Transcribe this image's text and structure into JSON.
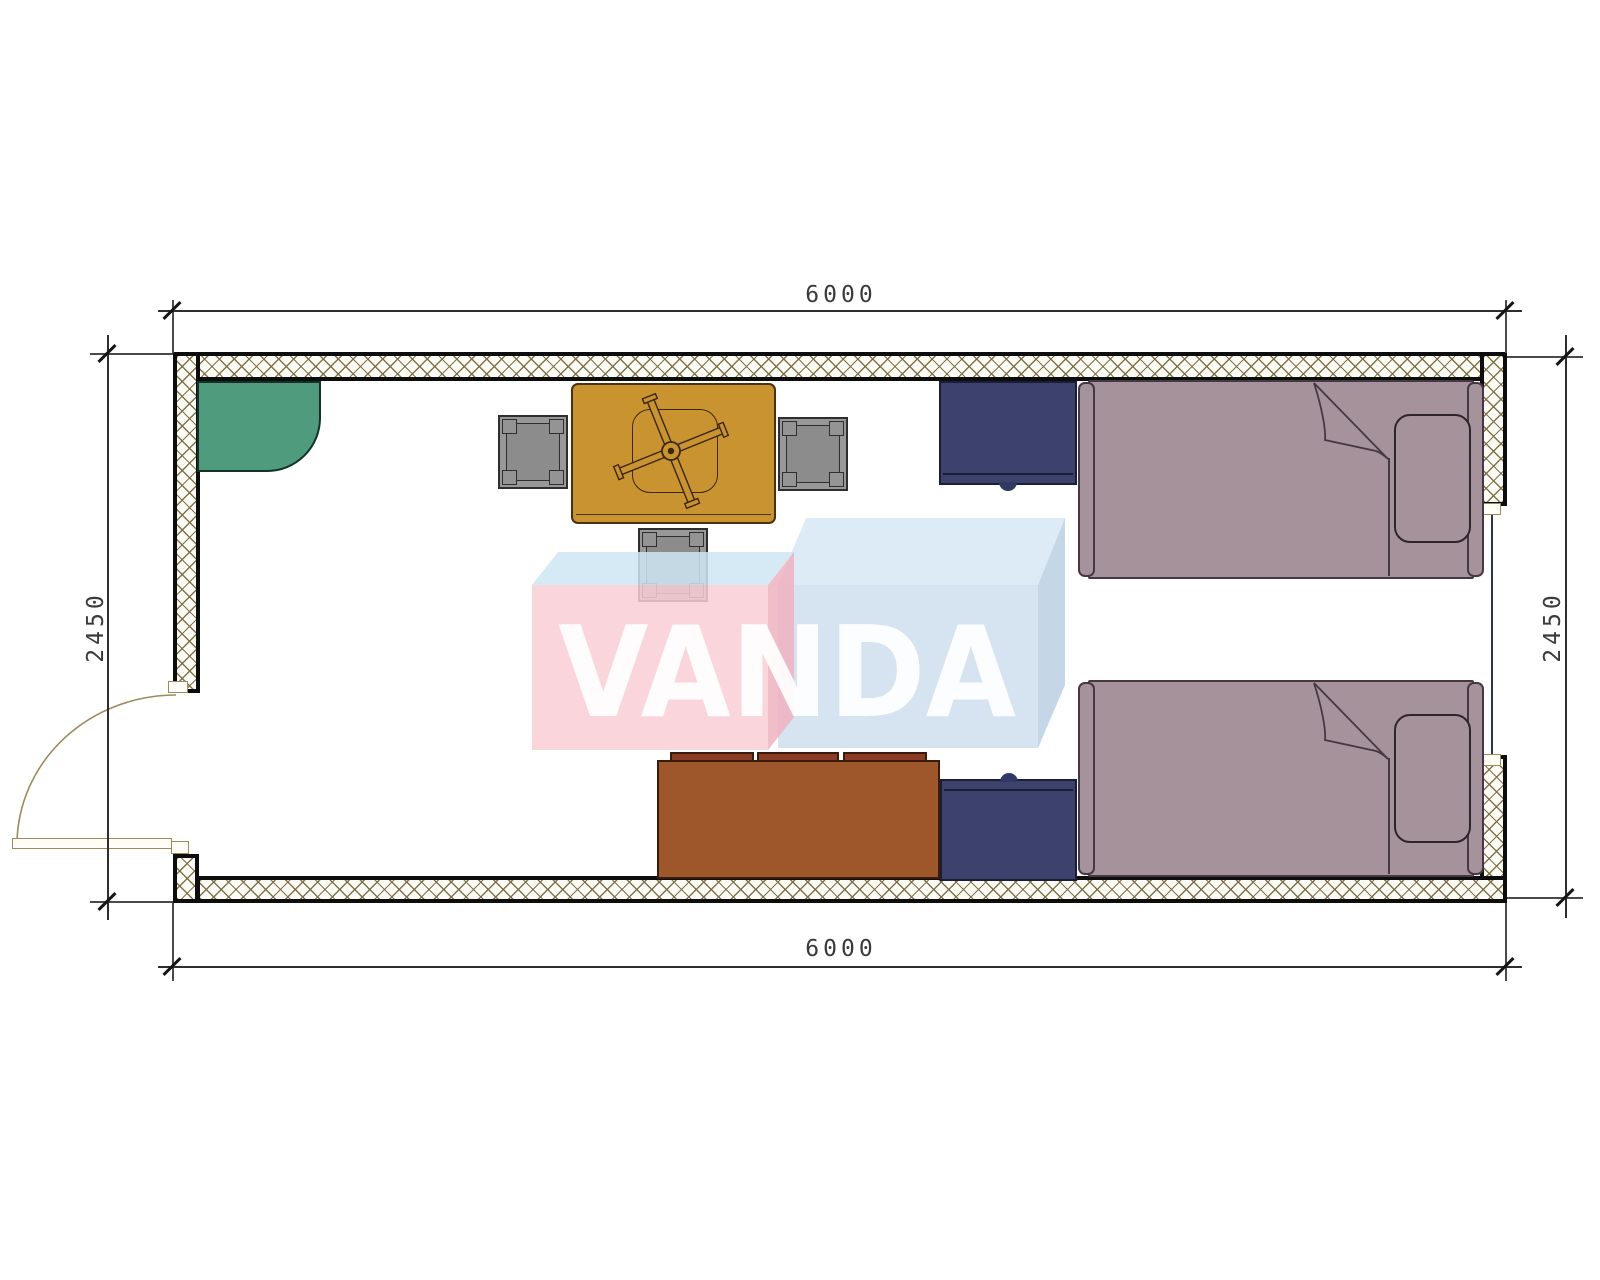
{
  "dimensions": {
    "top": "6000",
    "bottom": "6000",
    "left": "2450",
    "right": "2450"
  },
  "watermark": {
    "brand": "VANDA"
  },
  "symbols": [
    "exterior-wall-hatched",
    "hinged-door-swing",
    "window",
    "corner-shelf",
    "dining-table",
    "ceiling-fan",
    "stool",
    "stool",
    "stool",
    "cabinet",
    "cabinet",
    "single-bed",
    "single-bed",
    "sofa"
  ],
  "colors": {
    "wall_hatch": "#7a6c3e",
    "corner_shelf": "#4f9b7d",
    "table": "#c9932f",
    "cabinet_navy": "#3c426b",
    "bed_mauve": "#a5929b",
    "sofa_brown": "#9d572b",
    "watermark_pink": "#f9ced6",
    "watermark_blue": "#c6d8ea",
    "watermark_top": "#d3e6f3"
  }
}
